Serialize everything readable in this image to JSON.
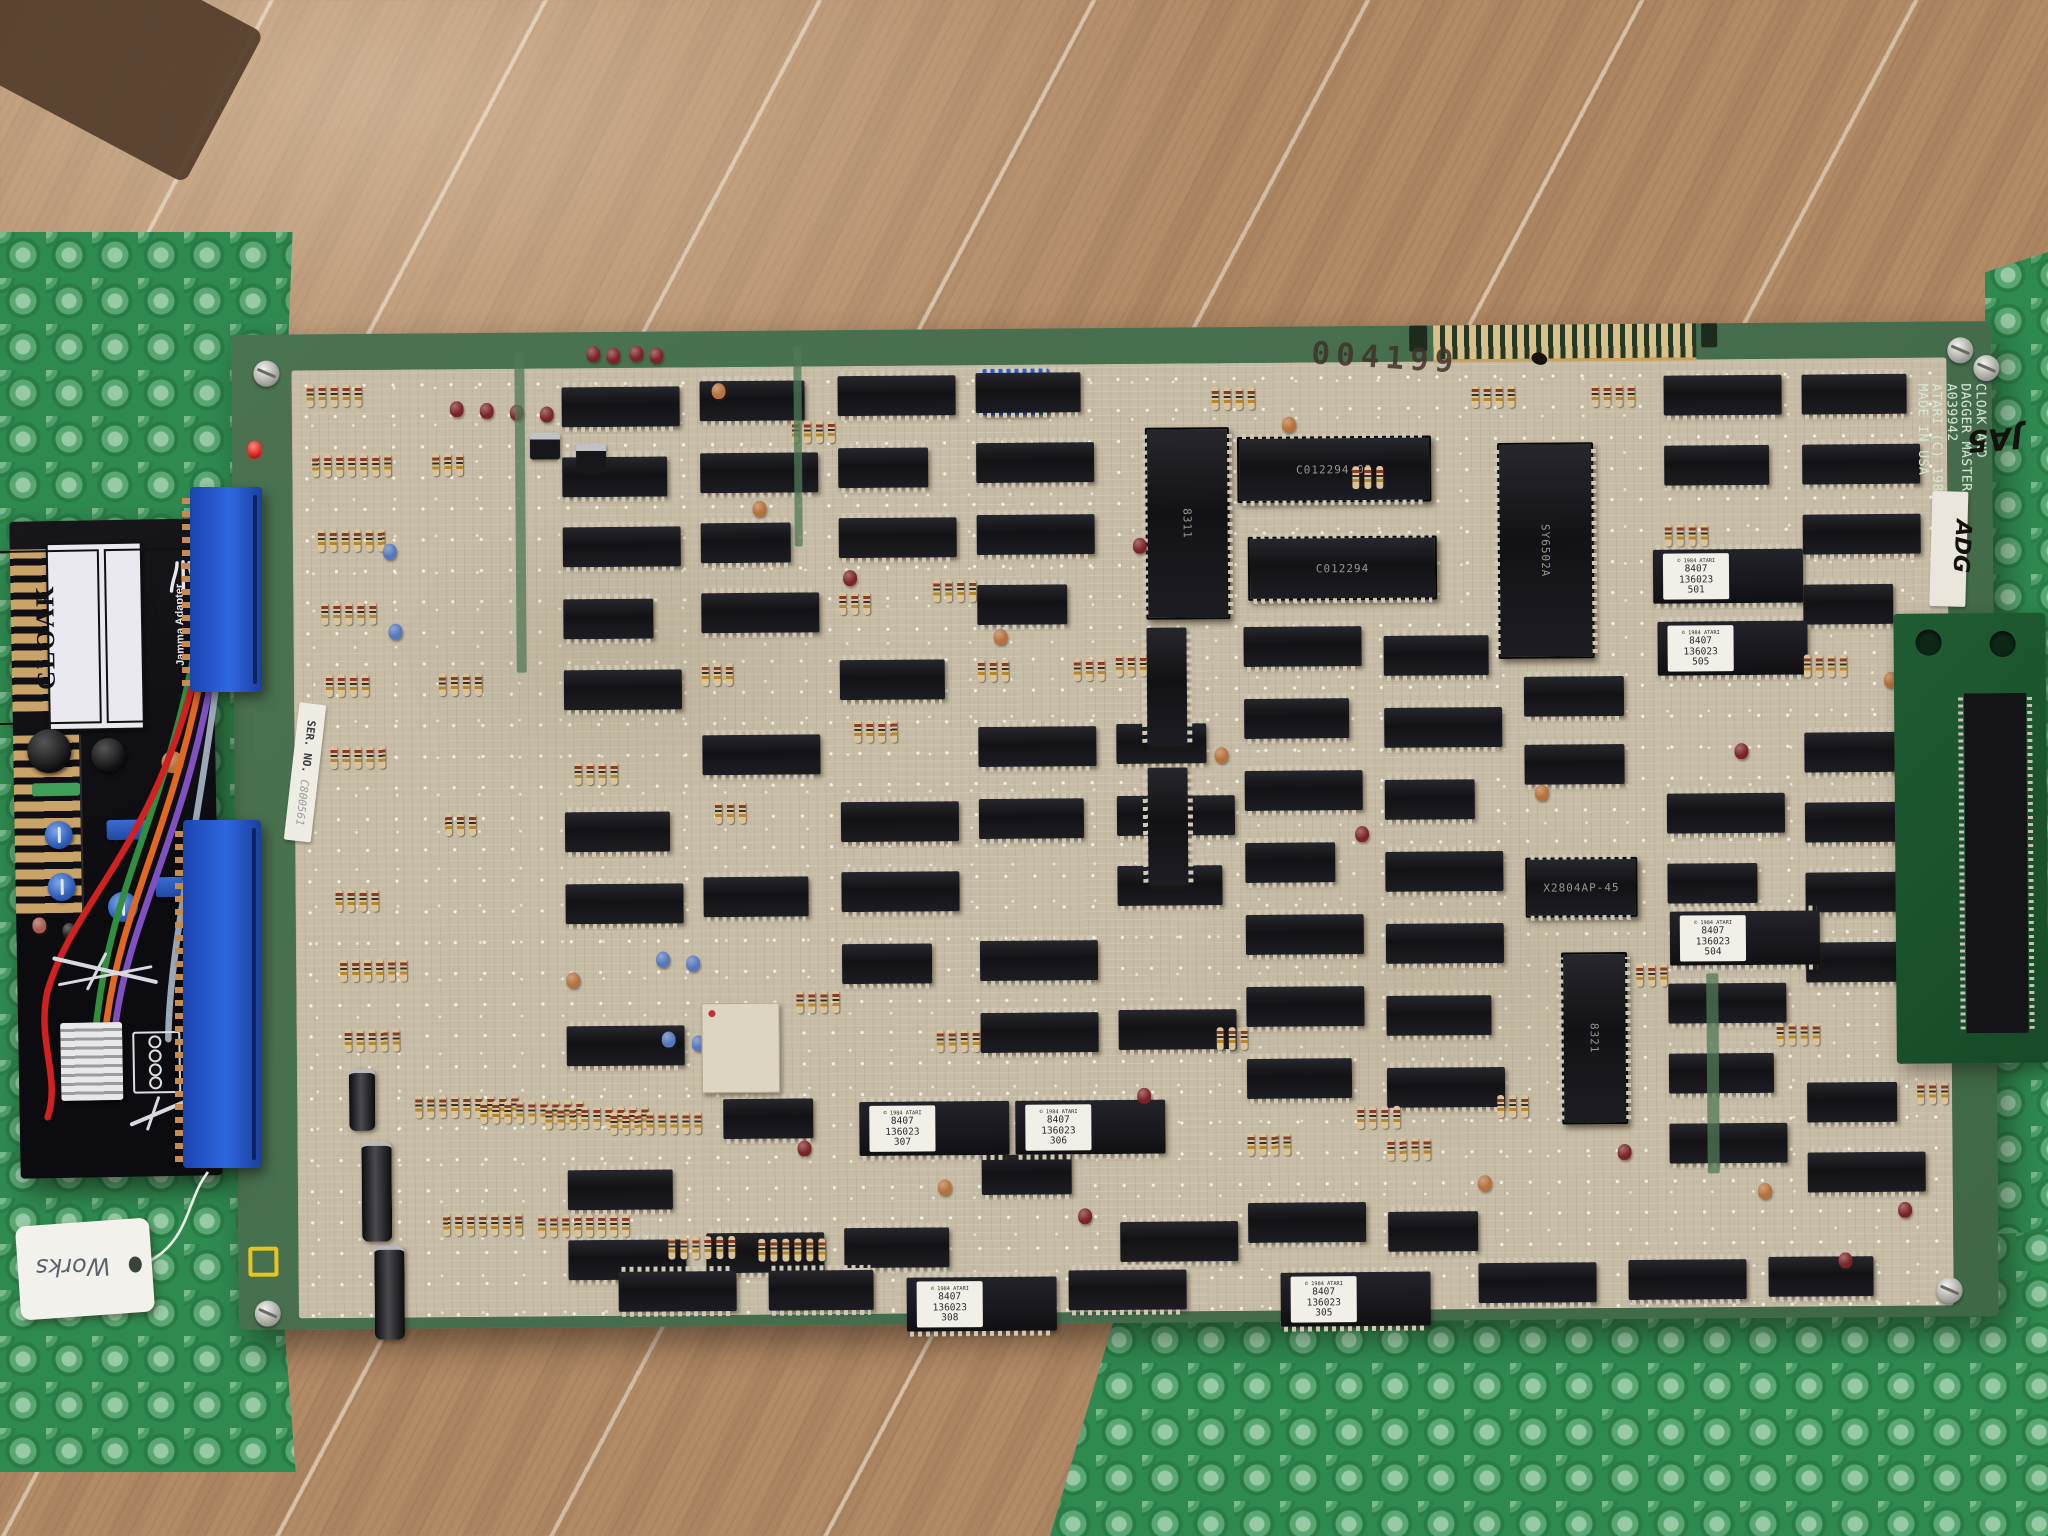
{
  "scene": {
    "description": "Atari Cloak & Dagger arcade PCB with JAMMA adapter on green bubble wrap over wood-tile floor"
  },
  "tag": {
    "text": "Works"
  },
  "adapter": {
    "game1": "CLOAK",
    "game2": "DAGGER",
    "subtitle": "Jamma Adapter",
    "brand": "ATARI",
    "pcb_side": "PCB Side"
  },
  "board": {
    "stamp": "004199",
    "silkscreen": [
      "CLOAK AND",
      "DAGGER MASTER",
      "A039942",
      "ATARI (C) 1983",
      "MADE IN USA"
    ],
    "marker_ja5": "JA5",
    "marker_dash21": "-21",
    "label_adg": "ADG",
    "ser_label": "SER. NO.",
    "ser_number": "C800561",
    "dip_numbers": [
      "1",
      "2",
      "3",
      "4",
      "5",
      "6",
      "7",
      "8"
    ],
    "eprom_header": "© 1984 ATARI",
    "eprom_date": "8407",
    "eprom_part": "136023",
    "colors": {
      "pcb_green": "#47714e",
      "mask_tan": "#c6bca6",
      "wrap_green": "#2f8a50",
      "connector_blue": "#2f67e0",
      "cap_palette": [
        "#7a2428",
        "#b5703c",
        "#5577bb"
      ]
    },
    "chips": [
      [
        330,
        55,
        118
      ],
      [
        330,
        125,
        105
      ],
      [
        330,
        195,
        118
      ],
      [
        330,
        267,
        90
      ],
      [
        330,
        338,
        118
      ],
      [
        330,
        480,
        105
      ],
      [
        330,
        552,
        118
      ],
      [
        330,
        694,
        118
      ],
      [
        330,
        838,
        105
      ],
      [
        330,
        908,
        118
      ],
      [
        468,
        50,
        105
      ],
      [
        468,
        122,
        118
      ],
      [
        468,
        192,
        90
      ],
      [
        468,
        262,
        118
      ],
      [
        468,
        404,
        118
      ],
      [
        468,
        546,
        105
      ],
      [
        486,
        768,
        90
      ],
      [
        468,
        902,
        118
      ],
      [
        606,
        46,
        118
      ],
      [
        606,
        118,
        90
      ],
      [
        606,
        188,
        118
      ],
      [
        606,
        330,
        105
      ],
      [
        606,
        472,
        118
      ],
      [
        606,
        542,
        118
      ],
      [
        606,
        614,
        90
      ],
      [
        606,
        898,
        105
      ],
      [
        744,
        44,
        105
      ],
      [
        744,
        114,
        118
      ],
      [
        744,
        186,
        118
      ],
      [
        744,
        256,
        90
      ],
      [
        744,
        398,
        118
      ],
      [
        744,
        470,
        105
      ],
      [
        744,
        612,
        118
      ],
      [
        744,
        684,
        118
      ],
      [
        744,
        826,
        90
      ],
      [
        882,
        396,
        90
      ],
      [
        882,
        468,
        118
      ],
      [
        882,
        538,
        105
      ],
      [
        882,
        682,
        118
      ],
      [
        882,
        894,
        118
      ],
      [
        1010,
        300,
        118
      ],
      [
        1010,
        372,
        105
      ],
      [
        1010,
        444,
        118
      ],
      [
        1010,
        516,
        90
      ],
      [
        1010,
        588,
        118
      ],
      [
        1010,
        660,
        118
      ],
      [
        1010,
        732,
        105
      ],
      [
        1010,
        876,
        118
      ],
      [
        1150,
        310,
        105
      ],
      [
        1150,
        382,
        118
      ],
      [
        1150,
        454,
        90
      ],
      [
        1150,
        526,
        118
      ],
      [
        1150,
        598,
        118
      ],
      [
        1150,
        670,
        105
      ],
      [
        1150,
        742,
        118
      ],
      [
        1150,
        886,
        90
      ],
      [
        1290,
        352,
        100
      ],
      [
        1290,
        420,
        100
      ],
      [
        1432,
        52,
        118
      ],
      [
        1432,
        122,
        105
      ],
      [
        1432,
        470,
        118
      ],
      [
        1432,
        540,
        90
      ],
      [
        1432,
        660,
        118
      ],
      [
        1432,
        730,
        105
      ],
      [
        1432,
        800,
        118
      ],
      [
        1570,
        52,
        105
      ],
      [
        1570,
        122,
        118
      ],
      [
        1570,
        192,
        118
      ],
      [
        1570,
        262,
        90
      ],
      [
        1570,
        410,
        118
      ],
      [
        1570,
        480,
        105
      ],
      [
        1570,
        550,
        118
      ],
      [
        1570,
        620,
        118
      ],
      [
        1570,
        760,
        90
      ],
      [
        1570,
        830,
        118
      ],
      [
        380,
        940,
        118
      ],
      [
        530,
        940,
        105
      ],
      [
        830,
        942,
        118
      ],
      [
        1240,
        938,
        118
      ],
      [
        1390,
        936,
        118
      ],
      [
        1530,
        934,
        105
      ]
    ],
    "chips_v": [
      [
        913,
        300
      ],
      [
        913,
        440
      ],
      [
        1700,
        320
      ],
      [
        1700,
        460
      ],
      [
        1700,
        600
      ]
    ],
    "big_h": [
      [
        1005,
        110,
        190,
        62,
        "C012294-03"
      ],
      [
        1015,
        210,
        185,
        60,
        "C012294"
      ],
      [
        1290,
        533,
        108,
        56,
        "X2804AP-45"
      ]
    ],
    "big_v": [
      [
        1265,
        118,
        92,
        212,
        "SY6502A"
      ],
      [
        913,
        100,
        80,
        188,
        "8311"
      ],
      [
        1325,
        628,
        62,
        168,
        "8321"
      ]
    ],
    "eproms": [
      [
        1420,
        226,
        "501"
      ],
      [
        1424,
        298,
        "505"
      ],
      [
        1434,
        588,
        "504"
      ],
      [
        622,
        772,
        "307"
      ],
      [
        778,
        772,
        "306"
      ],
      [
        668,
        948,
        "308"
      ],
      [
        1042,
        946,
        "305"
      ]
    ],
    "res_clusters": [
      [
        75,
        50,
        5
      ],
      [
        80,
        120,
        7
      ],
      [
        85,
        195,
        6
      ],
      [
        88,
        268,
        5
      ],
      [
        92,
        340,
        4
      ],
      [
        96,
        412,
        5
      ],
      [
        100,
        555,
        4
      ],
      [
        104,
        625,
        6
      ],
      [
        108,
        695,
        5
      ],
      [
        178,
        762,
        9
      ],
      [
        243,
        768,
        9
      ],
      [
        308,
        774,
        9
      ],
      [
        373,
        780,
        8
      ],
      [
        205,
        880,
        7
      ],
      [
        300,
        882,
        8
      ],
      [
        430,
        905,
        6
      ],
      [
        520,
        908,
        6
      ],
      [
        560,
        90,
        4
      ],
      [
        700,
        250,
        4
      ],
      [
        840,
        330,
        3
      ],
      [
        980,
        60,
        4
      ],
      [
        1120,
        140,
        3
      ],
      [
        560,
        660,
        4
      ],
      [
        700,
        700,
        4
      ],
      [
        980,
        700,
        3
      ],
      [
        1120,
        780,
        4
      ],
      [
        1260,
        770,
        3
      ],
      [
        1400,
        640,
        3
      ],
      [
        1540,
        700,
        4
      ],
      [
        1680,
        760,
        3
      ],
      [
        340,
        430,
        4
      ],
      [
        480,
        470,
        3
      ],
      [
        620,
        390,
        4
      ],
      [
        200,
        120,
        3
      ],
      [
        205,
        340,
        4
      ],
      [
        210,
        480,
        3
      ],
      [
        1432,
        200,
        4
      ],
      [
        1570,
        332,
        4
      ],
      [
        1010,
        806,
        4
      ],
      [
        1150,
        812,
        4
      ],
      [
        882,
        326,
        3
      ],
      [
        744,
        330,
        3
      ],
      [
        606,
        262,
        3
      ],
      [
        468,
        332,
        3
      ],
      [
        1240,
        60,
        4
      ],
      [
        1360,
        60,
        4
      ]
    ],
    "caps": [
      [
        218,
        68,
        0
      ],
      [
        248,
        70,
        0
      ],
      [
        278,
        72,
        0
      ],
      [
        308,
        74,
        0
      ],
      [
        355,
        14,
        0
      ],
      [
        375,
        16,
        0
      ],
      [
        398,
        14,
        0
      ],
      [
        418,
        16,
        0
      ],
      [
        520,
        170,
        1
      ],
      [
        610,
        240,
        0
      ],
      [
        760,
        300,
        1
      ],
      [
        900,
        210,
        0
      ],
      [
        1050,
        90,
        1
      ],
      [
        420,
        620,
        2
      ],
      [
        450,
        624,
        2
      ],
      [
        425,
        700,
        2
      ],
      [
        455,
        704,
        2
      ],
      [
        150,
        210,
        2
      ],
      [
        155,
        290,
        2
      ],
      [
        980,
        420,
        1
      ],
      [
        1120,
        500,
        0
      ],
      [
        1300,
        460,
        1
      ],
      [
        1500,
        420,
        0
      ],
      [
        1650,
        350,
        1
      ],
      [
        560,
        810,
        0
      ],
      [
        700,
        850,
        1
      ],
      [
        840,
        880,
        0
      ],
      [
        1240,
        850,
        1
      ],
      [
        1380,
        820,
        0
      ],
      [
        1520,
        860,
        1
      ],
      [
        1660,
        880,
        0
      ],
      [
        330,
        640,
        1
      ],
      [
        900,
        760,
        0
      ],
      [
        1700,
        300,
        0
      ],
      [
        480,
        52,
        1
      ],
      [
        1600,
        930,
        0
      ]
    ],
    "ecaps": [
      [
        112,
        735,
        26,
        58
      ],
      [
        124,
        808,
        30,
        96
      ],
      [
        136,
        912,
        30,
        90
      ]
    ],
    "transistors": [
      [
        298,
        100
      ],
      [
        344,
        112
      ]
    ],
    "modules": [
      [
        465,
        672,
        76,
        88
      ]
    ],
    "slivers": [
      [
        283,
        20,
        10,
        320
      ],
      [
        562,
        16,
        8,
        200
      ],
      [
        1470,
        650,
        12,
        200
      ]
    ],
    "screws": [
      [
        22,
        26
      ],
      [
        1716,
        16
      ],
      [
        16,
        966
      ],
      [
        1698,
        956
      ],
      [
        1742,
        34
      ]
    ]
  }
}
